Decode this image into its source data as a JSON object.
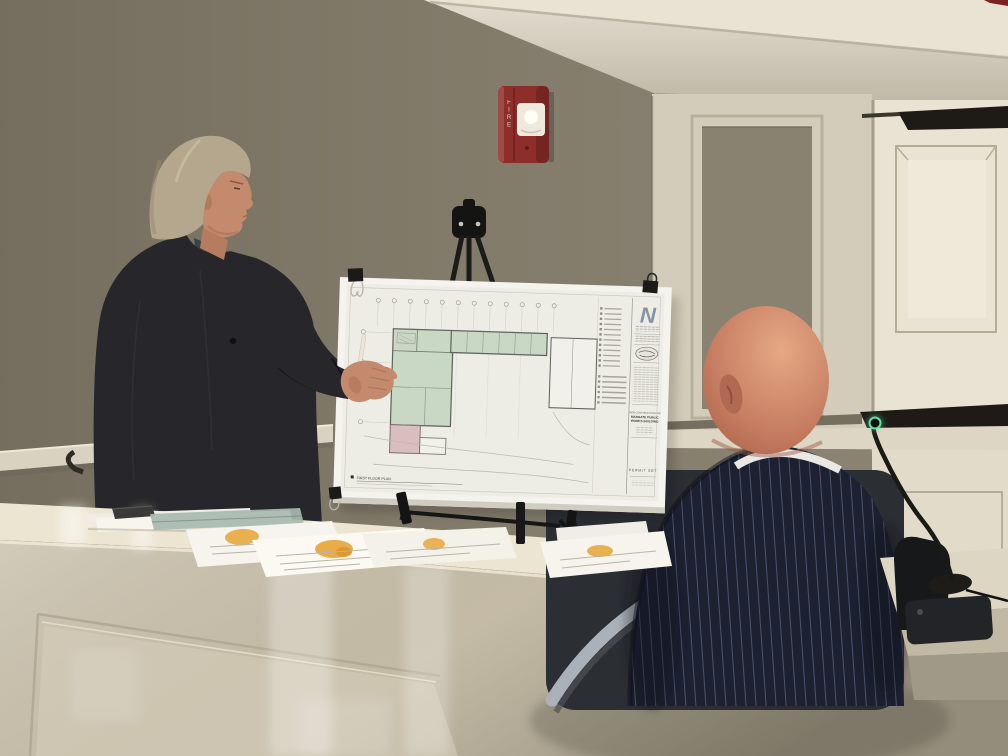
{
  "poster": {
    "title_block": {
      "firm_logo": "N",
      "project_label": "NEW CONSTRUCTION FOR",
      "project_name_line1": "MARGATE PUBLIC",
      "project_name_line2": "WORKS BUILDING",
      "set_label": "PERMIT SET"
    },
    "plan_label": "FIRST FLOOR PLAN"
  },
  "fire_alarm": {
    "label": "FIRE"
  },
  "colors": {
    "wall": "#867e6d",
    "molding": "#d8d1bf",
    "ceiling": "#e9e3d3",
    "wainscot": "#d3ccba",
    "panel_inner": "#8a8270",
    "door": "#e9e3d3",
    "screen_bar": "#1e1b16",
    "rail_cream": "#d9d2c0",
    "alarm_red": "#8e2e2a",
    "counter": "#ece5d1",
    "desk_front": "#c9c0ab",
    "poster_board": "#f4f3ee",
    "sheet_white": "#edece5",
    "plan_green": "#c9d7c5",
    "plan_pink": "#d9bec0",
    "logo_blue": "#8795a3",
    "jacket_charcoal": "#27272b",
    "khaki": "#98886c",
    "skin": "#c38a6e",
    "hair": "#b5a78d",
    "seated_skin": "#c87f63",
    "suit_navy": "#1c2030",
    "pinstripe": "#55607a",
    "collar_white": "#eae8e3",
    "chair_gray": "#33363b",
    "chrome": "#aab1b8",
    "mic_led_green": "#5fe3a1",
    "paper_highlight_orange": "#e8a83e",
    "brochure_teal": "#a8b8b0",
    "table_cream": "#ddd6c3"
  }
}
